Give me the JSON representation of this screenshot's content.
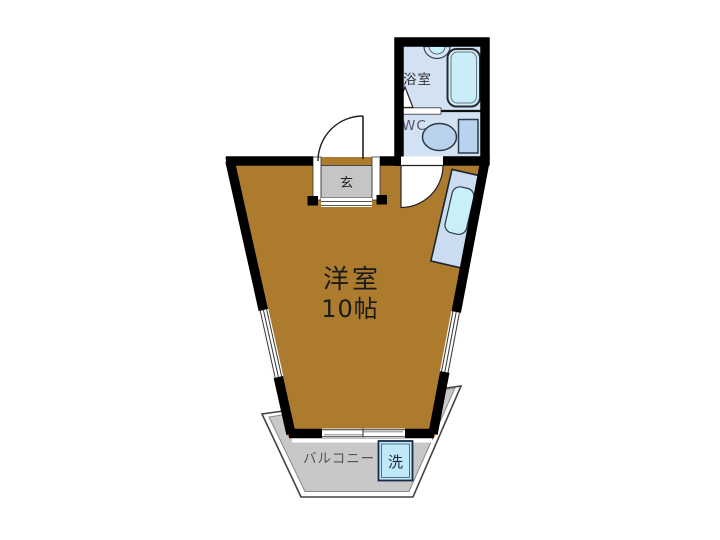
{
  "labels": {
    "entrance": "玄",
    "bathroom": "浴室",
    "toilet": "WC",
    "main_room_name": "洋室",
    "main_room_size": "10帖",
    "balcony": "バルコニー",
    "washing_machine": "洗"
  },
  "colors": {
    "wall": "#000000",
    "room_floor": "#ac7b2e",
    "wet_area_floor": "#d3e2f3",
    "fixture_blue": "#b9d3ee",
    "tub_cyan": "#c9eef7",
    "washer_cyan": "#bfe9f7",
    "balcony_gray": "#c8c8c8",
    "genkan_gray": "#c5c5c5",
    "kitchen_unit_blue": "#ccdcf0",
    "sink_cyan": "#c9f0f8",
    "label_gray": "#555555",
    "text_black": "#1a1a1a"
  }
}
